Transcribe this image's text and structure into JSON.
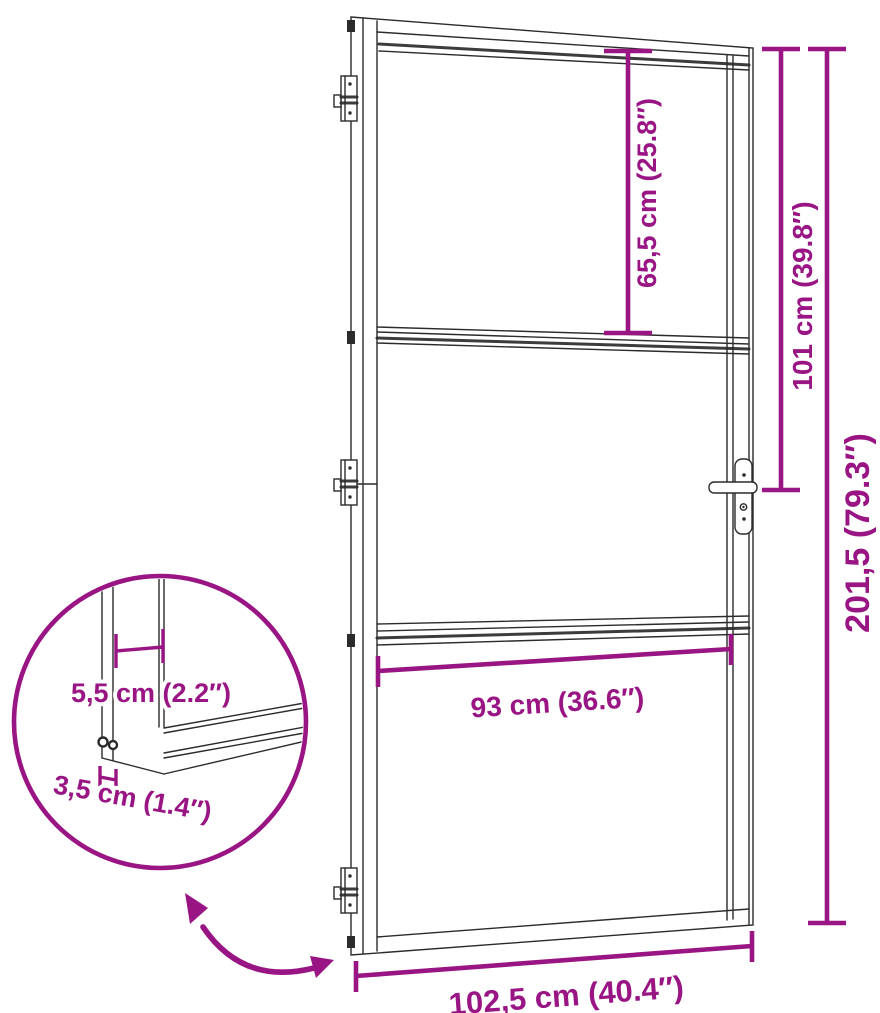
{
  "figure": {
    "kind": "product dimension diagram",
    "subject": "interior glass door with metal frame, three glass panels, three hinges and lever handle"
  },
  "colors": {
    "dimension_accent": "#9A1584",
    "drawing_line": "#2b2b2b",
    "background": "#ffffff"
  },
  "dimension_labels": {
    "top_panel_height": "65,5 cm (25.8″)",
    "handle_height": "101 cm (39.8″)",
    "total_height": "201,5 (79.3″)",
    "glass_width": "93 cm (36.6″)",
    "total_width": "102,5 cm (40.4″)",
    "detail_profile_width": "5,5 cm (2.2″)",
    "detail_profile_depth": "3,5 cm (1.4″)"
  }
}
